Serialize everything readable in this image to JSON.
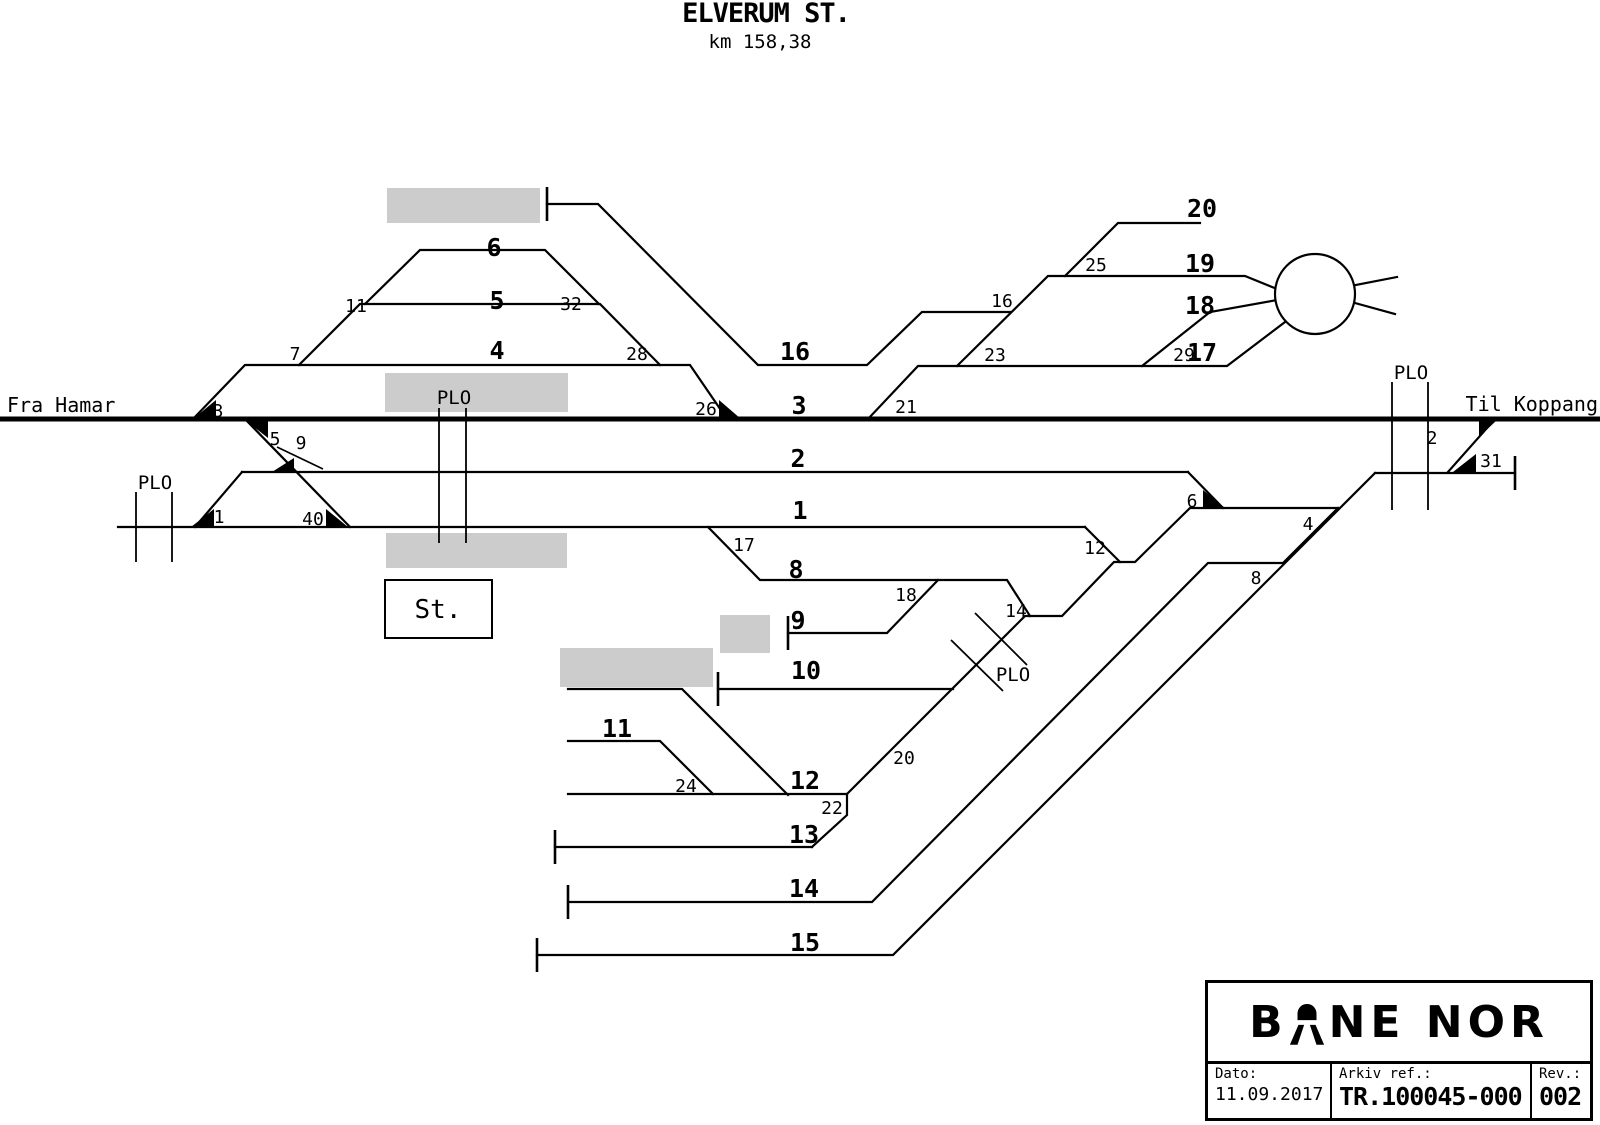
{
  "title": "ELVERUM ST.",
  "subtitle": "km 158,38",
  "left_direction": "Fra Hamar",
  "right_direction": "Til Koppang",
  "station_building": "St.",
  "plo_label": "PLO",
  "tracks": {
    "t1": "1",
    "t2": "2",
    "t3": "3",
    "t4": "4",
    "t5": "5",
    "t6": "6",
    "t8": "8",
    "t9": "9",
    "t10": "10",
    "t11": "11",
    "t12": "12",
    "t13": "13",
    "t14": "14",
    "t15": "15",
    "t16": "16",
    "t17": "17",
    "t18": "18",
    "t19": "19",
    "t20": "20"
  },
  "switches": {
    "s1": "1",
    "s2": "2",
    "s3": "3",
    "s4": "4",
    "s5": "5",
    "s6": "6",
    "s7": "7",
    "s8": "8",
    "s9": "9",
    "s11": "11",
    "s12": "12",
    "s14": "14",
    "s16": "16",
    "s17": "17",
    "s18": "18",
    "s20": "20",
    "s21": "21",
    "s22": "22",
    "s23": "23",
    "s24": "24",
    "s25": "25",
    "s26": "26",
    "s28": "28",
    "s29": "29",
    "s31": "31",
    "s32": "32",
    "s40": "40"
  },
  "title_block": {
    "brand_left": "B",
    "brand_right": "NE NOR",
    "date_label": "Dato:",
    "date_value": "11.09.2017",
    "ref_label": "Arkiv ref.:",
    "ref_value": "TR.100045-000",
    "rev_label": "Rev.:",
    "rev_value": "002"
  },
  "colors": {
    "line": "#000000",
    "platform": "#cccccc",
    "background": "#ffffff"
  }
}
